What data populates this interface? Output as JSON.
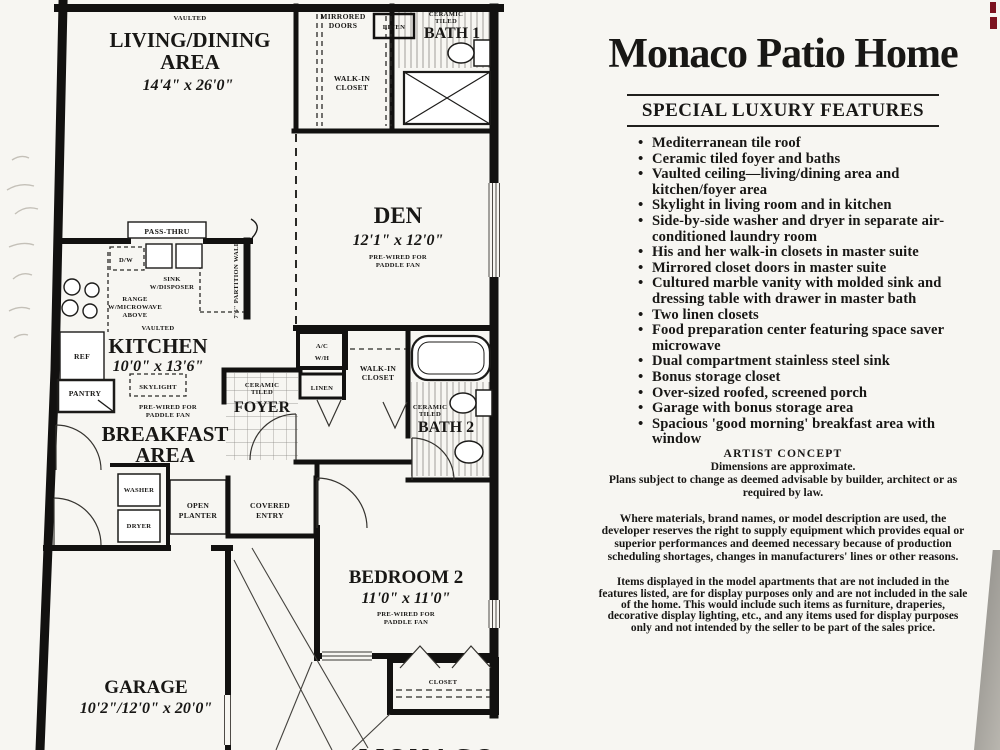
{
  "plan": {
    "living": {
      "tag": "VAULTED",
      "line1": "LIVING/DINING",
      "line2": "AREA",
      "dims": "14'4\" x 26'0\""
    },
    "den": {
      "name": "DEN",
      "dims": "12'1\" x 12'0\"",
      "note1": "PRE-WIRED FOR",
      "note2": "PADDLE FAN"
    },
    "kitchen": {
      "tag": "VAULTED",
      "name": "KITCHEN",
      "dims": "10'0\" x 13'6\"",
      "skylight": "SKYLIGHT"
    },
    "breakfast": {
      "note1": "PRE-WIRED FOR",
      "note2": "PADDLE FAN",
      "line1": "BREAKFAST",
      "line2": "AREA"
    },
    "bedroom2": {
      "name": "BEDROOM 2",
      "dims": "11'0\" x 11'0\"",
      "note1": "PRE-WIRED FOR",
      "note2": "PADDLE FAN",
      "closet": "CLOSET"
    },
    "garage": {
      "name": "GARAGE",
      "dims": "10'2\"/12'0\" x 20'0\""
    },
    "bath1": {
      "tag1": "CERAMIC",
      "tag2": "TILED",
      "name": "BATH 1"
    },
    "bath2": {
      "tag1": "CERAMIC",
      "tag2": "TILED",
      "name": "BATH 2"
    },
    "foyer": {
      "tag1": "CERAMIC",
      "tag2": "TILED",
      "name": "FOYER"
    },
    "labels": {
      "mirrored1": "MIRRORED",
      "mirrored2": "DOORS",
      "linen_top": "LINEN",
      "walkin1a": "WALK-IN",
      "walkin1b": "CLOSET",
      "passthru": "PASS-THRU",
      "dw": "D/W",
      "sink1": "SINK",
      "sink2": "W/DISPOSER",
      "range1": "RANGE",
      "range2": "W/MICROWAVE",
      "range3": "ABOVE",
      "partition": "7'6\" PARTITION WALL",
      "ref": "REF",
      "pantry": "PANTRY",
      "ac": "A/C",
      "wh": "W/H",
      "linen2": "LINEN",
      "walkin2a": "WALK-IN",
      "walkin2b": "CLOSET",
      "washer": "WASHER",
      "dryer": "DRYER",
      "planter1": "OPEN",
      "planter2": "PLANTER",
      "entry1": "COVERED",
      "entry2": "ENTRY",
      "monaco": "MONACO"
    }
  },
  "sidebar": {
    "title": "Monaco Patio Home",
    "features_heading": "SPECIAL LUXURY FEATURES",
    "features": [
      "Mediterranean tile roof",
      "Ceramic tiled foyer and baths",
      "Vaulted ceiling—living/dining area and kitchen/foyer area",
      "Skylight in living room and in kitchen",
      "Side-by-side washer and dryer in separate air-conditioned laundry room",
      "His and her walk-in closets in master suite",
      "Mirrored closet doors in master suite",
      "Cultured marble vanity with molded sink and dressing table with drawer in master bath",
      "Two linen closets",
      "Food preparation center featuring space saver microwave",
      "Dual compartment stainless steel sink",
      "Bonus storage closet",
      "Over-sized roofed, screened porch",
      "Garage with bonus storage area",
      "Spacious 'good morning' breakfast area with window"
    ],
    "artist_concept": "ARTIST CONCEPT",
    "disclaimer1a": "Dimensions are approximate.",
    "disclaimer1b": "Plans subject to change as deemed advisable by builder, architect or as required by law.",
    "disclaimer2": "Where materials, brand names, or model description are used, the developer reserves the right to supply equipment which provides equal or superior performances and deemed necessary because of production scheduling shortages, changes in manufacturers' lines or other reasons.",
    "disclaimer3": "Items displayed in the model apartments that are not included in the features listed, are for display purposes only and are not included in the sale of the home. This would include such items as furniture, draperies, decorative display lighting, etc., and any items used for display purposes only and not intended by the seller to be part of the sales price."
  }
}
